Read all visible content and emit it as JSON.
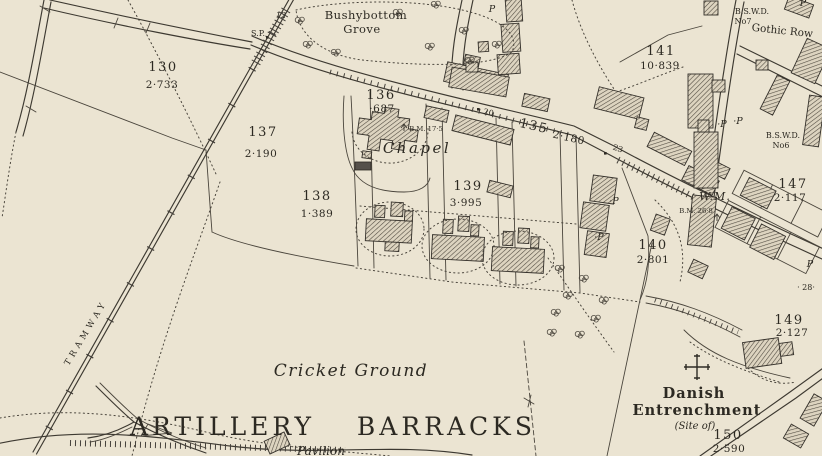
{
  "palette": {
    "paper": "#ebe4d2",
    "ink": "#3d3931",
    "building_hatch": "#4e483e"
  },
  "labels": {
    "grove_line1": "Bushybottom",
    "grove_line2": "Grove",
    "chapel": "Chapel",
    "cricket_ground": "Cricket Ground",
    "artillery_barracks": "ARTILLERY BARRACKS",
    "pavilion": "Pavilion",
    "tramway": "TRAMWAY",
    "gothic_row": "Gothic Row",
    "danish_line1": "Danish",
    "danish_line2": "Entrenchment",
    "danish_line3": "(Site of)",
    "wm": "W.M.",
    "bswd_no7_line1": "B.S.W.D.",
    "bswd_no7_line2": "No7",
    "bswd_no6_line1": "B.S.W.D.",
    "bswd_no6_line2": "No6",
    "bm_17_5": "B.M. 17·5",
    "bm_26_8": "B.M. 26·8",
    "sp": "S.P.",
    "num_12": "12",
    "num_20": "20",
    "num_23": "23",
    "num_28": "· 28·",
    "p": "P",
    "p_dot": "·P"
  },
  "parcels": [
    {
      "number": "130",
      "acreage": "2·733"
    },
    {
      "number": "137",
      "acreage": "2·190"
    },
    {
      "number": "136",
      "acreage": "·687"
    },
    {
      "number": "135",
      "acreage": "2·180"
    },
    {
      "number": "138",
      "acreage": "1·389"
    },
    {
      "number": "139",
      "acreage": "3·995"
    },
    {
      "number": "141",
      "acreage": "10·839"
    },
    {
      "number": "140",
      "acreage": "2·801"
    },
    {
      "number": "147",
      "acreage": "2·117"
    },
    {
      "number": "149",
      "acreage": "2·127"
    },
    {
      "number": "150",
      "acreage": "2·590"
    }
  ]
}
